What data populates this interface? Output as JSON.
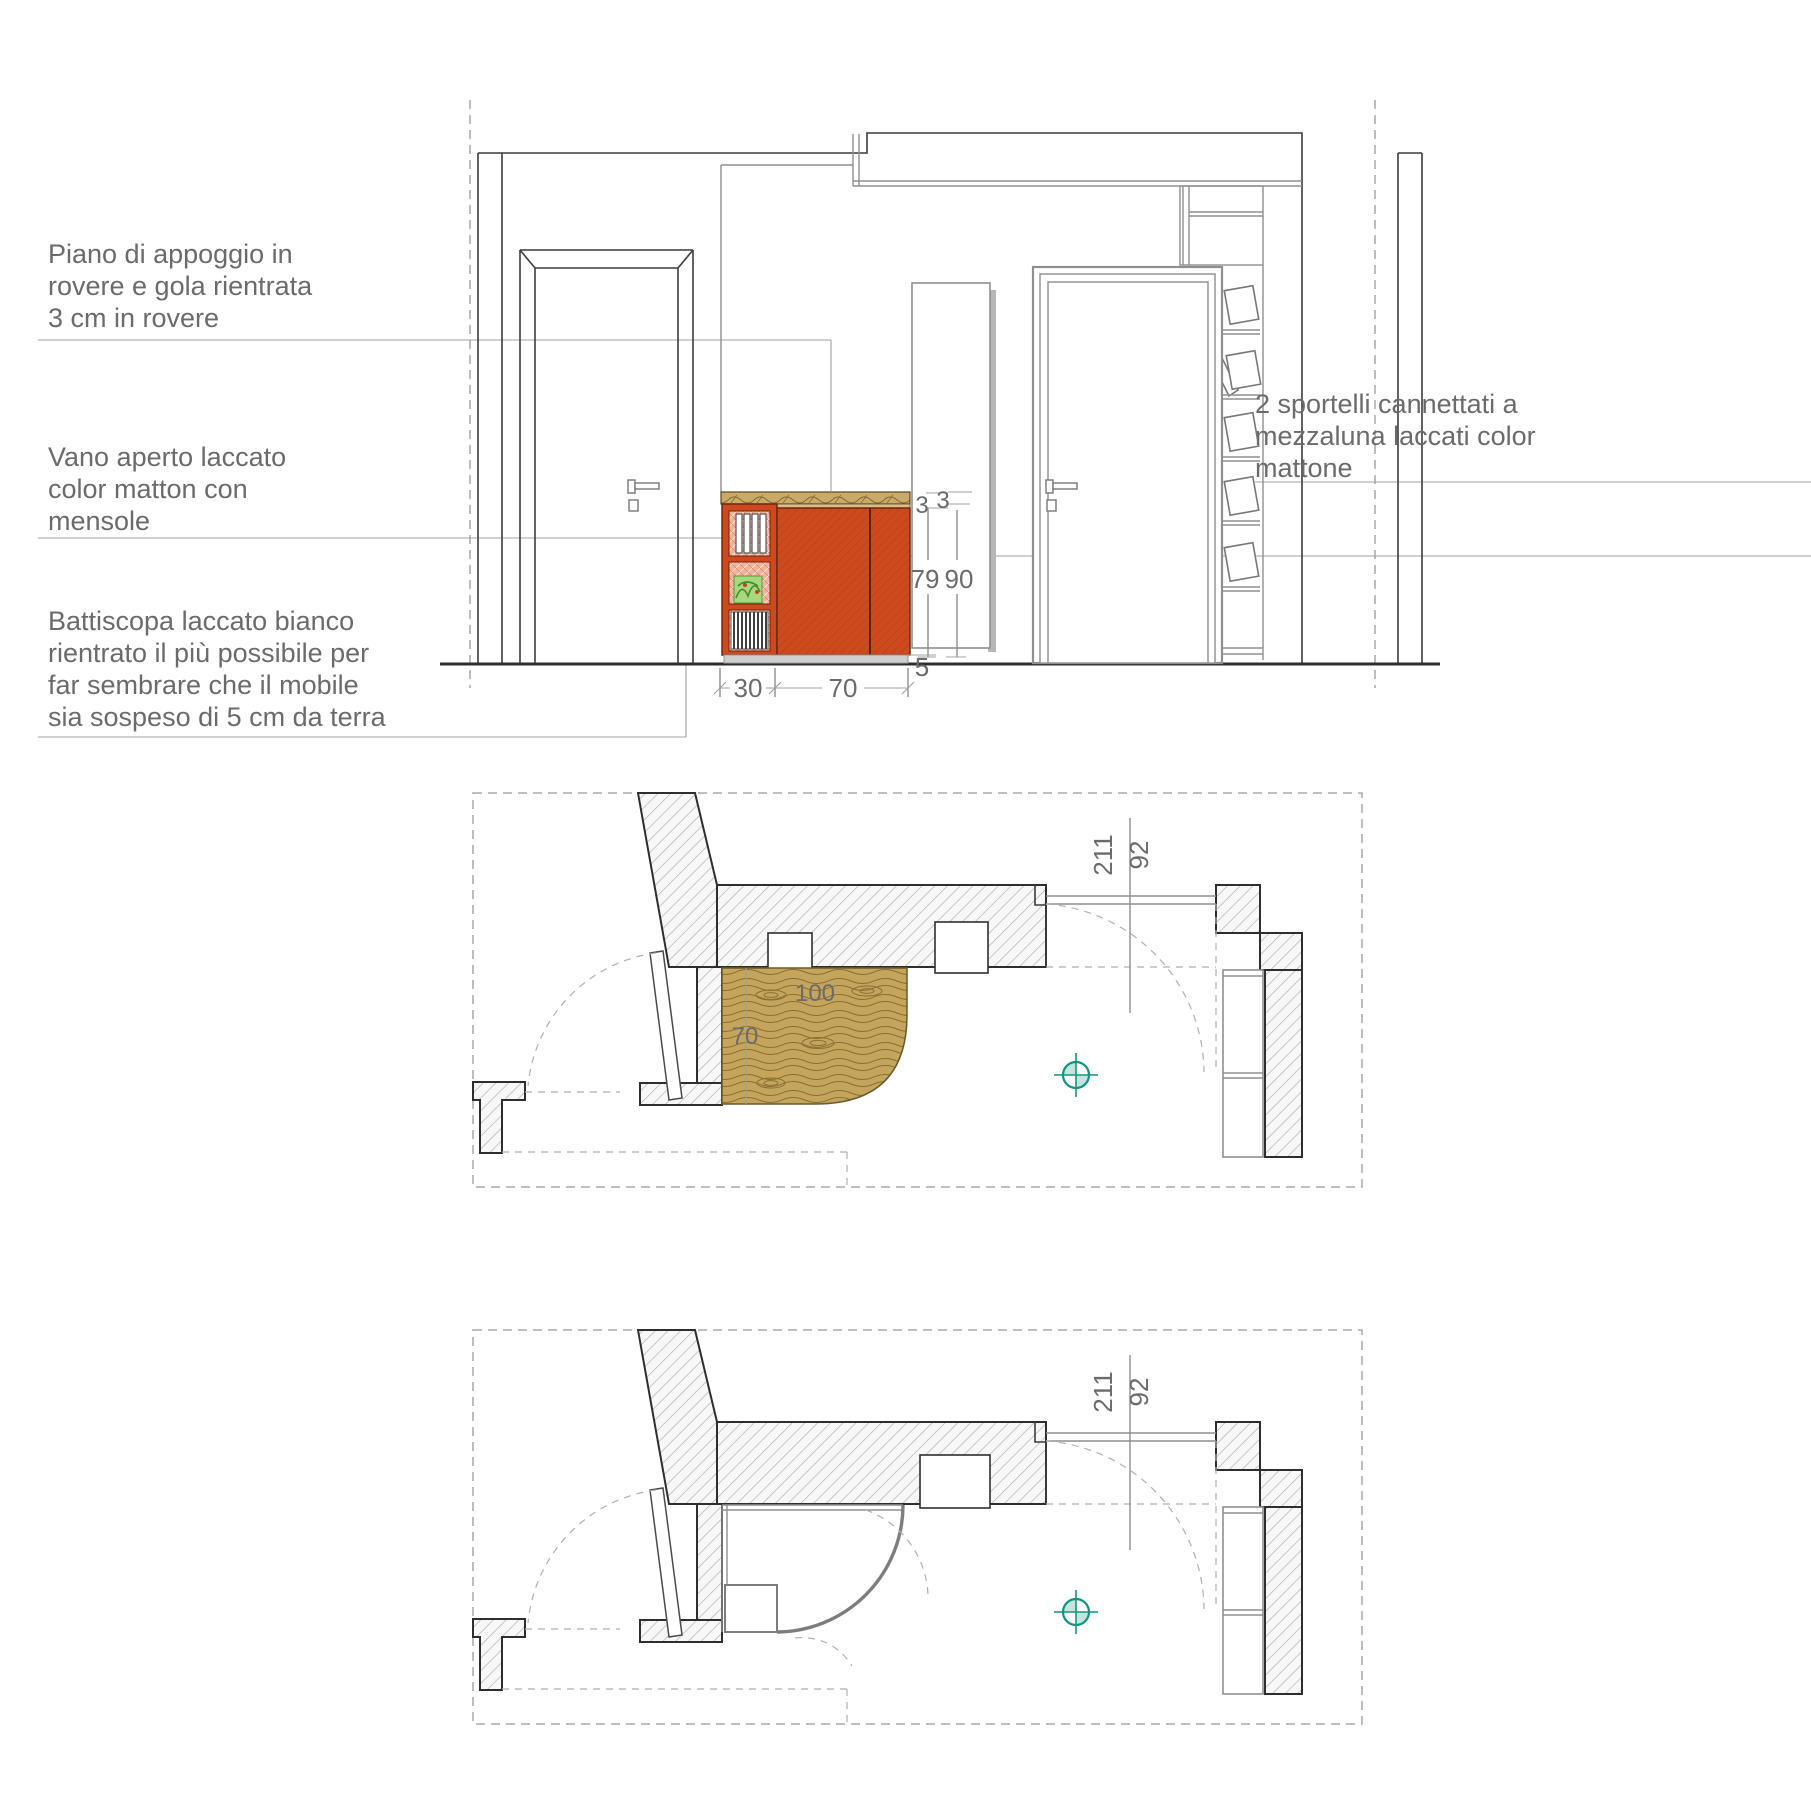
{
  "annotations": {
    "piano": {
      "lines": [
        "Piano di appoggio in",
        "rovere e gola rientrata",
        "3 cm in rovere"
      ]
    },
    "vano": {
      "lines": [
        "Vano aperto laccato",
        "color matton con",
        "mensole"
      ]
    },
    "battiscopa": {
      "lines": [
        "Battiscopa laccato bianco",
        "rientrato il più possibile per",
        "far sembrare che il mobile",
        "sia sospeso di 5 cm da terra"
      ]
    },
    "sportelli": {
      "lines": [
        "2 sportelli cannettati a",
        "mezzaluna laccati color",
        "mattone"
      ]
    }
  },
  "elevation_dims": {
    "counter_thickness": "3",
    "gola_recess": "3",
    "front_height": "79",
    "total_height": "90",
    "plinth_gap": "5",
    "open_unit_width": "30",
    "doors_width": "70"
  },
  "plan_top_dims": {
    "cabinet_width": "100",
    "cabinet_depth": "70",
    "door_opening_width": "92",
    "door_opening_height": "211"
  },
  "plan_bottom_dims": {
    "door_opening_width": "92",
    "door_opening_height": "211"
  },
  "colors": {
    "mattone": "#cc4a1e",
    "mattone-dark": "#6e2710",
    "wood": "#cbaa68",
    "wood-plan": "#c5a45c",
    "wood-line": "#8a7034",
    "salmon": "#f4b29a",
    "teal": "#13947f",
    "line-gray": "#8f8f8f",
    "text-gray": "#6b6b6b"
  }
}
